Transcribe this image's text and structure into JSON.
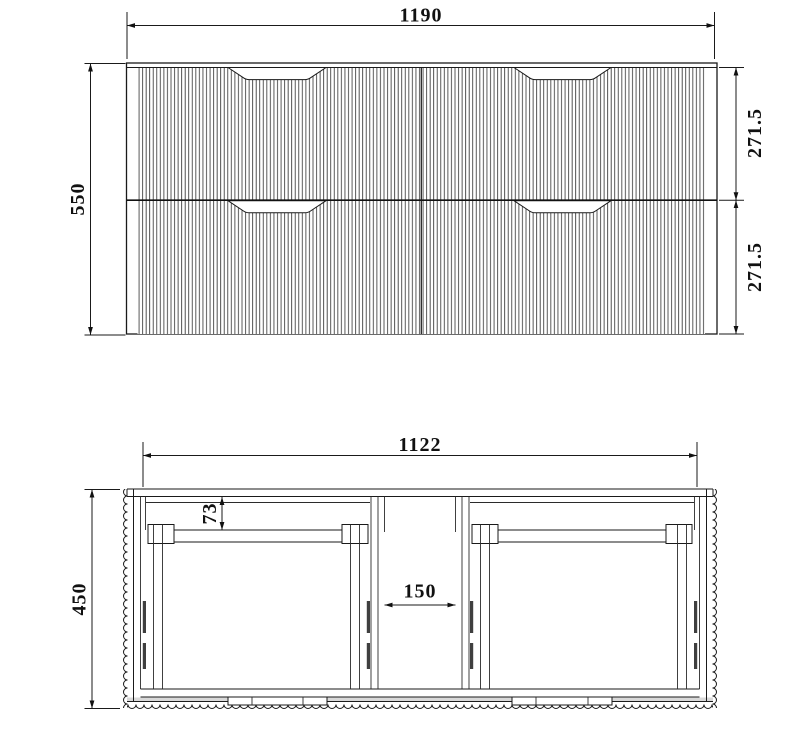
{
  "page": {
    "background_color": "#ffffff",
    "line_color": "#1a1a1a",
    "drawing_type": "vanity cabinet technical drawing"
  },
  "front_view": {
    "dim_width": "1190",
    "dim_height": "550",
    "dim_drawer_top": "271.5",
    "dim_drawer_bottom": "271.5"
  },
  "plan_view": {
    "dim_width": "1122",
    "dim_depth": "450",
    "dim_back_offset": "73",
    "dim_center_gap": "150"
  }
}
